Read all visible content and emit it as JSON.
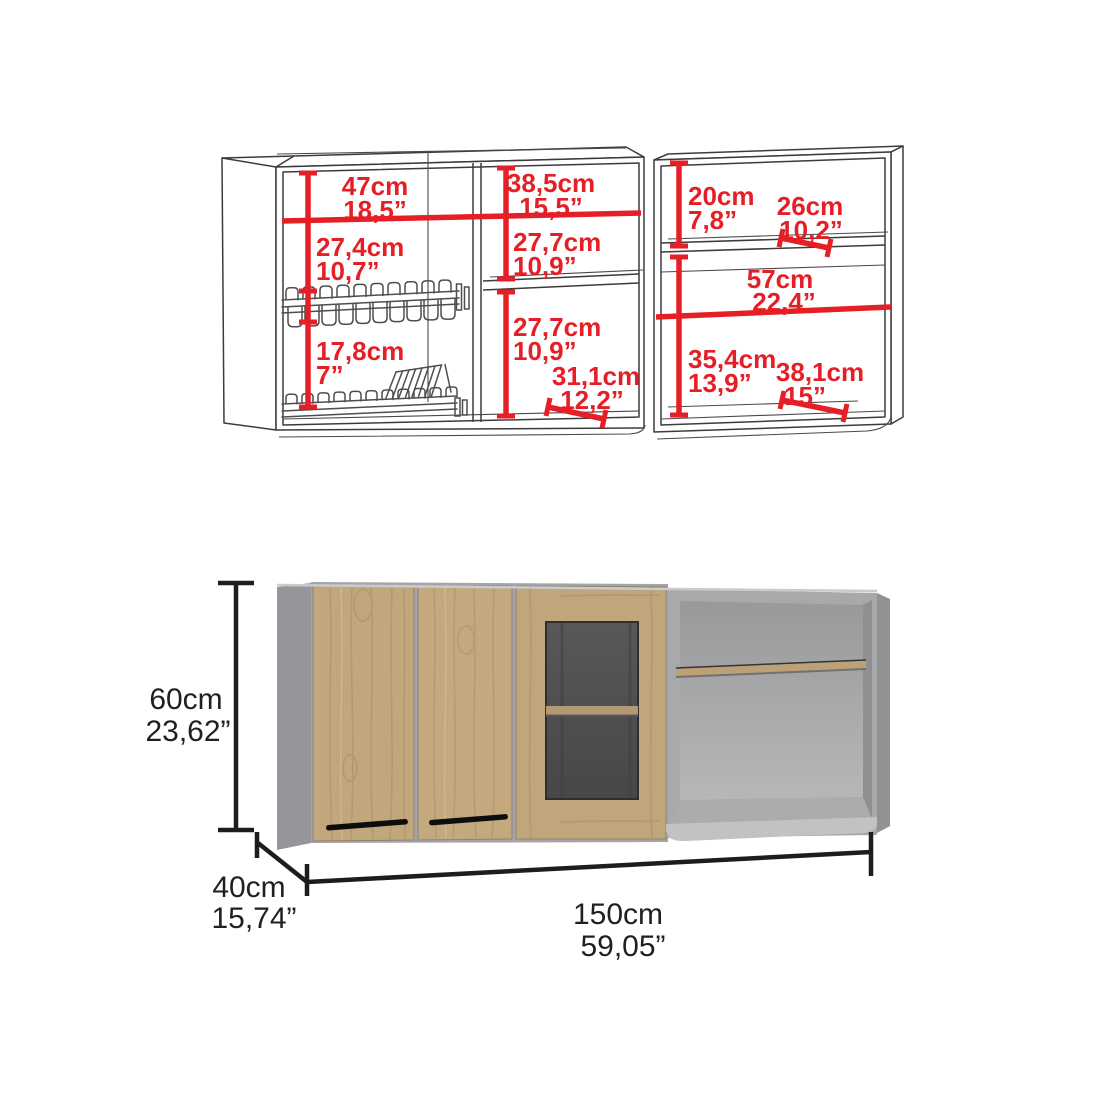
{
  "title": "Wall cabinet dimension diagram",
  "colors": {
    "dimension_red": "#e61e26",
    "dimension_black": "#1d1d1f",
    "wood": "#c2a67c",
    "carcass_grey": "#a3a5a7",
    "glass": "#4c4e50"
  },
  "top_view": {
    "left_cabinet": {
      "interior_width": {
        "cm": "47cm",
        "in": "18,5”"
      },
      "right_section_width": {
        "cm": "38,5cm",
        "in": "15,5”"
      },
      "upper_left_height": {
        "cm": "27,4cm",
        "in": "10,7”"
      },
      "upper_right_height": {
        "cm": "27,7cm",
        "in": "10,9”"
      },
      "lower_right_height": {
        "cm": "27,7cm",
        "in": "10,9”"
      },
      "rack_section_height": {
        "cm": "17,8cm",
        "in": "7”"
      },
      "interior_depth": {
        "cm": "31,1cm",
        "in": "12,2”"
      }
    },
    "right_cabinet": {
      "top_offset": {
        "cm": "20cm",
        "in": "7,8”"
      },
      "shelf_depth": {
        "cm": "26cm",
        "in": "10,2”"
      },
      "interior_width": {
        "cm": "57cm",
        "in": "22,4”"
      },
      "lower_section_height": {
        "cm": "35,4cm",
        "in": "13,9”"
      },
      "bottom_depth": {
        "cm": "38,1cm",
        "in": "15”"
      }
    }
  },
  "overall": {
    "height": {
      "cm": "60cm",
      "in": "23,62”"
    },
    "depth": {
      "cm": "40cm",
      "in": "15,74”"
    },
    "width": {
      "cm": "150cm",
      "in": "59,05”"
    }
  }
}
